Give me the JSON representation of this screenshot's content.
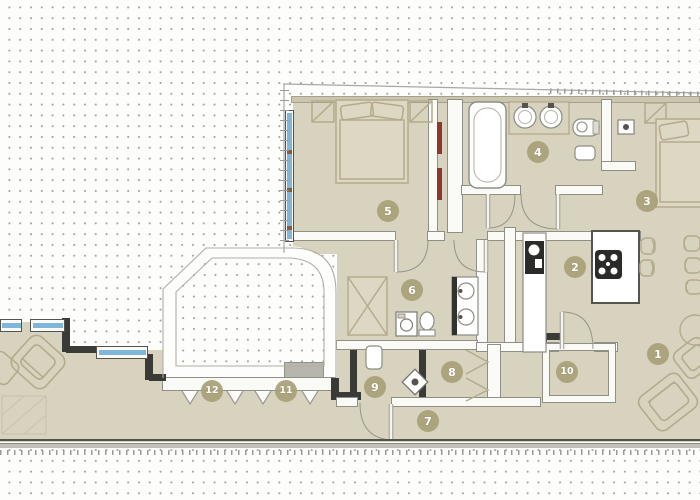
{
  "drawing": {
    "kind": "apartment-floor-plan",
    "rooms": [
      {
        "label": "1"
      },
      {
        "label": "2"
      },
      {
        "label": "3"
      },
      {
        "label": "4"
      },
      {
        "label": "5"
      },
      {
        "label": "6"
      },
      {
        "label": "7"
      },
      {
        "label": "8"
      },
      {
        "label": "9"
      },
      {
        "label": "10"
      },
      {
        "label": "11"
      },
      {
        "label": "12"
      }
    ],
    "palette": {
      "floor": "#d8d3be",
      "wall_light": "#fafaf7",
      "wall_dark": "#3a3a36",
      "wall_outline": "#908f86",
      "furniture_line": "#b3ab8c",
      "window_glass": "#7fb6d9",
      "door_leaf_red": "#8d382f",
      "badge_fill": "#a8a077",
      "badge_text": "#ffffff",
      "grid_dot": "#a3a39d",
      "boundary_line": "#a9a9a2",
      "step_gray": "#b7b6ad",
      "appliance_dark": "#2b2b28"
    }
  }
}
